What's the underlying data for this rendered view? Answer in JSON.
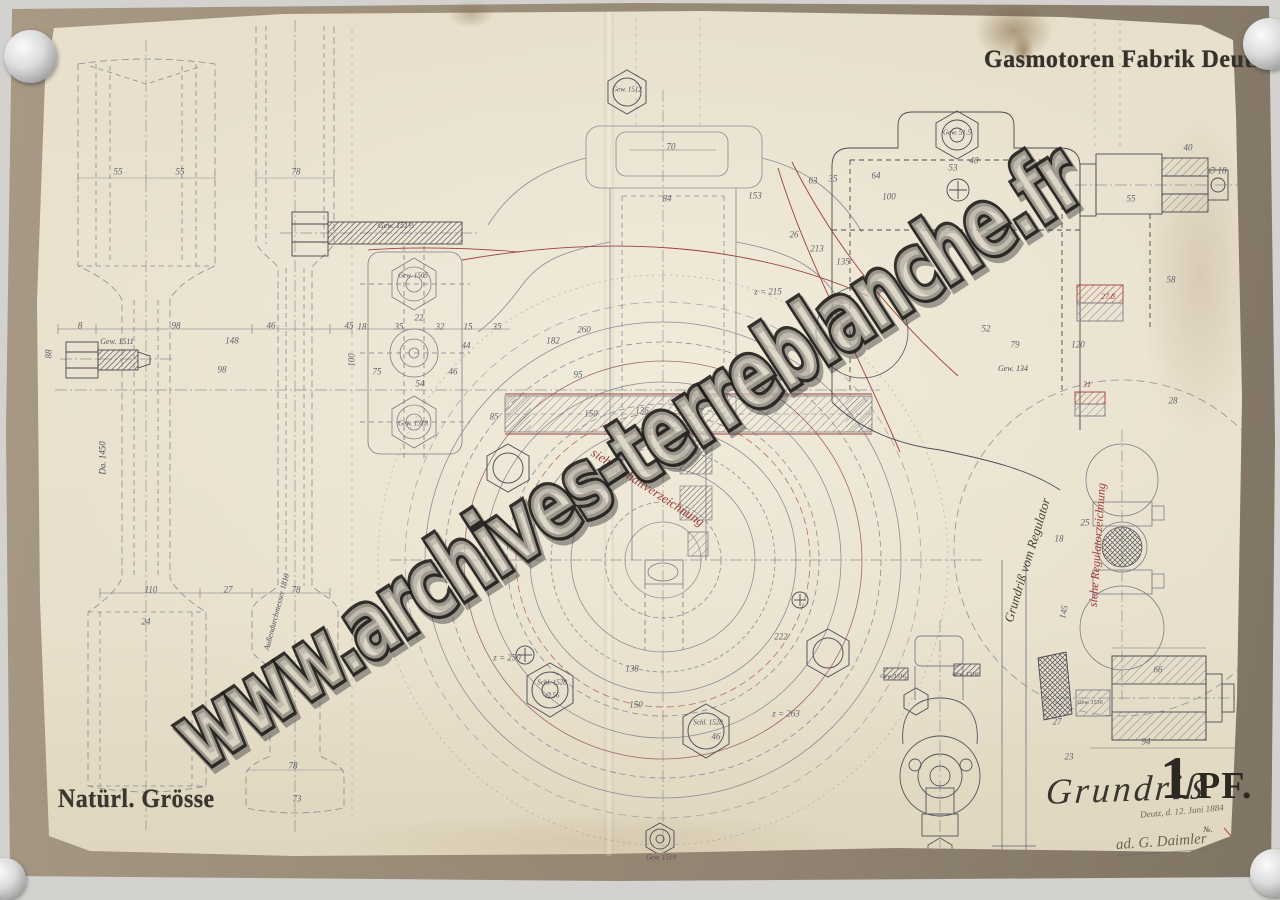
{
  "document": {
    "manufacturer": "Gasmotoren Fabrik Deutz",
    "scale_note": "Natürl. Grösse",
    "view_label": "Grundriß",
    "engine_rating_number": "1",
    "engine_rating_unit": "PF.",
    "date_note": "Deutz, d. 12. Juni 1884",
    "numero": "№.",
    "signature": "ad. G. Daimler",
    "watermark": "www.archives-terreblanche.fr"
  },
  "colors": {
    "paper": "#e9e1cd",
    "backing_mat": "#998c78",
    "stencil_ink": "#36322b",
    "pencil_line": "#8a8a95",
    "dark_ink": "#45454e",
    "red_accent": "#9c4040",
    "watermark_outline": "#1f1d1b"
  },
  "annotations": [
    {
      "t": "55",
      "x": 118,
      "y": 172
    },
    {
      "t": "55",
      "x": 180,
      "y": 172
    },
    {
      "t": "78",
      "x": 296,
      "y": 172
    },
    {
      "t": "8",
      "x": 80,
      "y": 326
    },
    {
      "t": "98",
      "x": 176,
      "y": 326
    },
    {
      "t": "46",
      "x": 271,
      "y": 326
    },
    {
      "t": "45",
      "x": 349,
      "y": 326
    },
    {
      "t": "88",
      "x": 49,
      "y": 354,
      "r": -90
    },
    {
      "t": "98",
      "x": 222,
      "y": 370
    },
    {
      "t": "148",
      "x": 232,
      "y": 341
    },
    {
      "t": "110",
      "x": 151,
      "y": 590
    },
    {
      "t": "27",
      "x": 228,
      "y": 590
    },
    {
      "t": "78",
      "x": 296,
      "y": 590
    },
    {
      "t": "24",
      "x": 146,
      "y": 622
    },
    {
      "t": "78",
      "x": 293,
      "y": 766
    },
    {
      "t": "73",
      "x": 297,
      "y": 799
    },
    {
      "t": "Da. 1450",
      "x": 103,
      "y": 458,
      "r": -90,
      "c": "script",
      "s": 9
    },
    {
      "t": "Außendurchmesser 1810",
      "x": 277,
      "y": 612,
      "r": -75,
      "c": "script",
      "s": 8
    },
    {
      "t": "Gew. 1511",
      "x": 117,
      "y": 342,
      "c": "script"
    },
    {
      "t": "Gew. 151½",
      "x": 396,
      "y": 226,
      "c": "script"
    },
    {
      "t": "Gew. 1505",
      "x": 413,
      "y": 276,
      "c": "script",
      "s": 7
    },
    {
      "t": "Gew. 1318",
      "x": 413,
      "y": 424,
      "c": "script",
      "s": 7
    },
    {
      "t": "Gew. 1512",
      "x": 627,
      "y": 90,
      "c": "script",
      "s": 7
    },
    {
      "t": "18",
      "x": 362,
      "y": 327
    },
    {
      "t": "35",
      "x": 399,
      "y": 327
    },
    {
      "t": "22",
      "x": 419,
      "y": 318
    },
    {
      "t": "32",
      "x": 440,
      "y": 327
    },
    {
      "t": "15",
      "x": 468,
      "y": 327
    },
    {
      "t": "35",
      "x": 497,
      "y": 327
    },
    {
      "t": "44",
      "x": 466,
      "y": 346
    },
    {
      "t": "46",
      "x": 453,
      "y": 372
    },
    {
      "t": "75",
      "x": 377,
      "y": 372
    },
    {
      "t": "54",
      "x": 420,
      "y": 384
    },
    {
      "t": "85",
      "x": 494,
      "y": 417
    },
    {
      "t": "100",
      "x": 352,
      "y": 360,
      "r": -90
    },
    {
      "t": "70",
      "x": 671,
      "y": 147
    },
    {
      "t": "84",
      "x": 667,
      "y": 199
    },
    {
      "t": "153",
      "x": 755,
      "y": 196
    },
    {
      "t": "26",
      "x": 794,
      "y": 235
    },
    {
      "t": "213",
      "x": 817,
      "y": 249
    },
    {
      "t": "63",
      "x": 813,
      "y": 181
    },
    {
      "t": "35",
      "x": 833,
      "y": 179
    },
    {
      "t": "135",
      "x": 843,
      "y": 262
    },
    {
      "t": "z = 215",
      "x": 768,
      "y": 292
    },
    {
      "t": "240",
      "x": 837,
      "y": 300
    },
    {
      "t": "z = 245",
      "x": 823,
      "y": 339
    },
    {
      "t": "182",
      "x": 553,
      "y": 341
    },
    {
      "t": "260",
      "x": 584,
      "y": 330
    },
    {
      "t": "95",
      "x": 578,
      "y": 375
    },
    {
      "t": "150",
      "x": 591,
      "y": 414
    },
    {
      "t": "136",
      "x": 642,
      "y": 411
    },
    {
      "t": "z = 250",
      "x": 507,
      "y": 658
    },
    {
      "t": "138",
      "x": 632,
      "y": 669
    },
    {
      "t": "150",
      "x": 636,
      "y": 705
    },
    {
      "t": "222",
      "x": 781,
      "y": 637
    },
    {
      "t": "z = 263",
      "x": 786,
      "y": 714
    },
    {
      "t": "Schl. 1528",
      "x": 552,
      "y": 683,
      "c": "script",
      "s": 7
    },
    {
      "t": "∅ 56",
      "x": 552,
      "y": 696,
      "c": "script",
      "s": 7
    },
    {
      "t": "Schl. 1528",
      "x": 708,
      "y": 723,
      "c": "script",
      "s": 7
    },
    {
      "t": "46",
      "x": 716,
      "y": 737
    },
    {
      "t": "Gew. 1519",
      "x": 661,
      "y": 858,
      "c": "script",
      "s": 7
    },
    {
      "t": "64",
      "x": 876,
      "y": 176
    },
    {
      "t": "100",
      "x": 889,
      "y": 197
    },
    {
      "t": "53",
      "x": 953,
      "y": 168
    },
    {
      "t": "40",
      "x": 974,
      "y": 161
    },
    {
      "t": "Gew. 51.5",
      "x": 957,
      "y": 133,
      "c": "script",
      "s": 7
    },
    {
      "t": "55",
      "x": 1131,
      "y": 199
    },
    {
      "t": "40",
      "x": 1188,
      "y": 148
    },
    {
      "t": "∅ 18",
      "x": 1217,
      "y": 171
    },
    {
      "t": "58",
      "x": 1171,
      "y": 280
    },
    {
      "t": "52",
      "x": 986,
      "y": 329
    },
    {
      "t": "79",
      "x": 1015,
      "y": 345
    },
    {
      "t": "120",
      "x": 1078,
      "y": 345
    },
    {
      "t": "28",
      "x": 1173,
      "y": 401
    },
    {
      "t": "Gew. 134",
      "x": 1013,
      "y": 369,
      "c": "script"
    },
    {
      "t": "27.8",
      "x": 1108,
      "y": 297,
      "c": "redscript",
      "s": 8
    },
    {
      "t": "31",
      "x": 1087,
      "y": 385,
      "c": "redscript",
      "s": 8
    },
    {
      "t": "25",
      "x": 1085,
      "y": 523
    },
    {
      "t": "18",
      "x": 1059,
      "y": 539
    },
    {
      "t": "145",
      "x": 1064,
      "y": 612,
      "r": -80
    },
    {
      "t": "66",
      "x": 1158,
      "y": 670
    },
    {
      "t": "94",
      "x": 1146,
      "y": 742
    },
    {
      "t": "23",
      "x": 1069,
      "y": 757
    },
    {
      "t": "27",
      "x": 1057,
      "y": 722
    },
    {
      "t": "Gew. 1516",
      "x": 1090,
      "y": 703,
      "c": "script",
      "s": 6
    },
    {
      "t": "Gew. 1316",
      "x": 893,
      "y": 677,
      "c": "script",
      "s": 6
    },
    {
      "t": "Gew. 1316",
      "x": 965,
      "y": 675,
      "c": "script",
      "s": 6
    },
    {
      "t": "Grundriß vom Regulator",
      "x": 1027,
      "y": 560,
      "r": -73,
      "c": "blackscript",
      "s": 13
    },
    {
      "t": "siehe Schaltverzeichnung",
      "x": 648,
      "y": 487,
      "r": 33,
      "c": "redscript",
      "s": 13
    },
    {
      "t": "siehe Regulatorzeichnung",
      "x": 1097,
      "y": 545,
      "r": -86,
      "c": "redscript",
      "s": 12
    },
    {
      "t": "№.",
      "x": 1208,
      "y": 830,
      "c": "blackscript",
      "s": 8
    }
  ]
}
